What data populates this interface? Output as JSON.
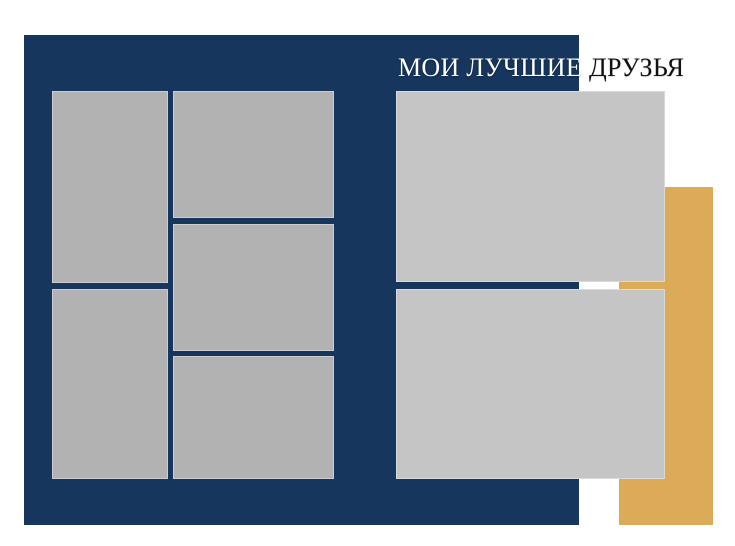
{
  "colors": {
    "page_white": "#ffffff",
    "navy": "#16365e",
    "gold": "#dcab57",
    "photo_gray_left": "#b2b2b2",
    "photo_gray_right": "#c5c5c5",
    "title_white": "#ffffff",
    "title_black": "#111111"
  },
  "title": {
    "part1": "МОИ ЛУЧШИЕ",
    "part2": "ДРУЗЬЯ",
    "full": "МОИ ЛУЧШИЕ ДРУЗЬЯ"
  },
  "photo_slots": [
    {
      "id": "left-top"
    },
    {
      "id": "left-bottom"
    },
    {
      "id": "center-top"
    },
    {
      "id": "center-middle"
    },
    {
      "id": "center-bottom"
    },
    {
      "id": "right-top"
    },
    {
      "id": "right-bottom"
    }
  ]
}
